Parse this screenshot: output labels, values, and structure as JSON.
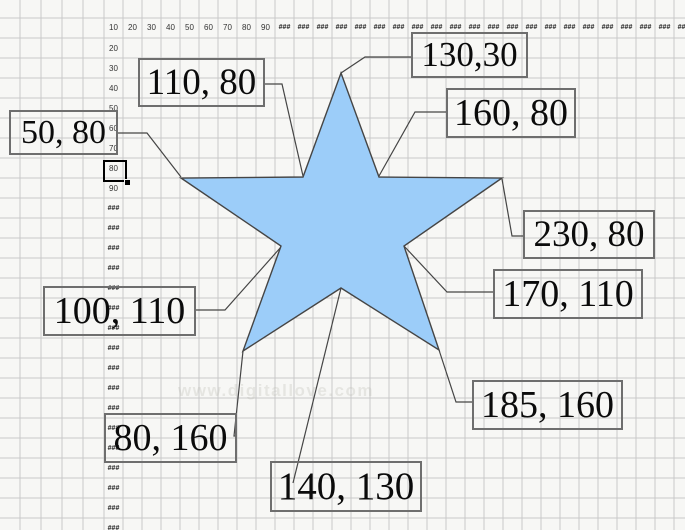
{
  "canvas": {
    "width": 685,
    "height": 530,
    "background": "#f7f7f5",
    "grid_color": "#c9c9c9"
  },
  "watermark": {
    "text": "www.digitallove.com"
  },
  "rulers": {
    "h_values": [
      "10",
      "20",
      "30",
      "40",
      "50",
      "60",
      "70",
      "80",
      "90"
    ],
    "v_values": [
      "20",
      "30",
      "40",
      "50",
      "60",
      "70",
      "80",
      "90"
    ],
    "overflow_mark": "###",
    "h_overflow_count": 22,
    "v_overflow_count": 17,
    "selected_cell_value": "80"
  },
  "star": {
    "fill": "#9ccdf9",
    "stroke": "#454545",
    "points_px": [
      [
        341,
        73
      ],
      [
        379,
        177
      ],
      [
        502,
        178
      ],
      [
        404,
        246
      ],
      [
        439,
        350
      ],
      [
        341,
        288
      ],
      [
        243,
        351
      ],
      [
        281,
        246
      ],
      [
        181,
        178
      ],
      [
        303,
        177
      ]
    ]
  },
  "labels": [
    {
      "text": "50, 80",
      "point": [
        50,
        80
      ],
      "box_px": [
        9,
        110,
        109,
        45
      ],
      "callout_px": [
        [
          118,
          133
        ],
        [
          147,
          133
        ],
        [
          181,
          177
        ]
      ]
    },
    {
      "text": "110, 80",
      "point": [
        110,
        80
      ],
      "box_px": [
        138,
        58,
        127,
        49
      ],
      "callout_px": [
        [
          265,
          84
        ],
        [
          282,
          84
        ],
        [
          303,
          176
        ]
      ]
    },
    {
      "text": "130,30",
      "point": [
        130,
        30
      ],
      "box_px": [
        411,
        32,
        117,
        46
      ],
      "callout_px": [
        [
          411,
          57
        ],
        [
          365,
          57
        ],
        [
          341,
          73
        ]
      ]
    },
    {
      "text": "160, 80",
      "point": [
        160,
        80
      ],
      "box_px": [
        446,
        88,
        130,
        50
      ],
      "callout_px": [
        [
          446,
          112
        ],
        [
          415,
          112
        ],
        [
          379,
          176
        ]
      ]
    },
    {
      "text": "230, 80",
      "point": [
        230,
        80
      ],
      "box_px": [
        523,
        210,
        132,
        49
      ],
      "callout_px": [
        [
          523,
          236
        ],
        [
          512,
          236
        ],
        [
          502,
          179
        ]
      ]
    },
    {
      "text": "170, 110",
      "point": [
        170,
        110
      ],
      "box_px": [
        493,
        269,
        150,
        50
      ],
      "callout_px": [
        [
          404,
          246
        ],
        [
          447,
          292
        ],
        [
          493,
          292
        ]
      ]
    },
    {
      "text": "100, 110",
      "point": [
        100,
        110
      ],
      "box_px": [
        43,
        286,
        153,
        50
      ],
      "callout_px": [
        [
          196,
          310
        ],
        [
          225,
          310
        ],
        [
          281,
          247
        ]
      ]
    },
    {
      "text": "185, 160",
      "point": [
        185,
        160
      ],
      "box_px": [
        472,
        380,
        151,
        50
      ],
      "callout_px": [
        [
          439,
          350
        ],
        [
          456,
          402
        ],
        [
          472,
          402
        ]
      ]
    },
    {
      "text": "80, 160",
      "point": [
        80,
        160
      ],
      "box_px": [
        104,
        413,
        133,
        50
      ],
      "callout_px": [
        [
          243,
          351
        ],
        [
          234,
          436
        ],
        [
          237,
          436
        ]
      ]
    },
    {
      "text": "140, 130",
      "point": [
        140,
        130
      ],
      "box_px": [
        270,
        461,
        152,
        51
      ],
      "callout_px": [
        [
          341,
          288
        ],
        [
          293,
          483
        ]
      ]
    }
  ]
}
